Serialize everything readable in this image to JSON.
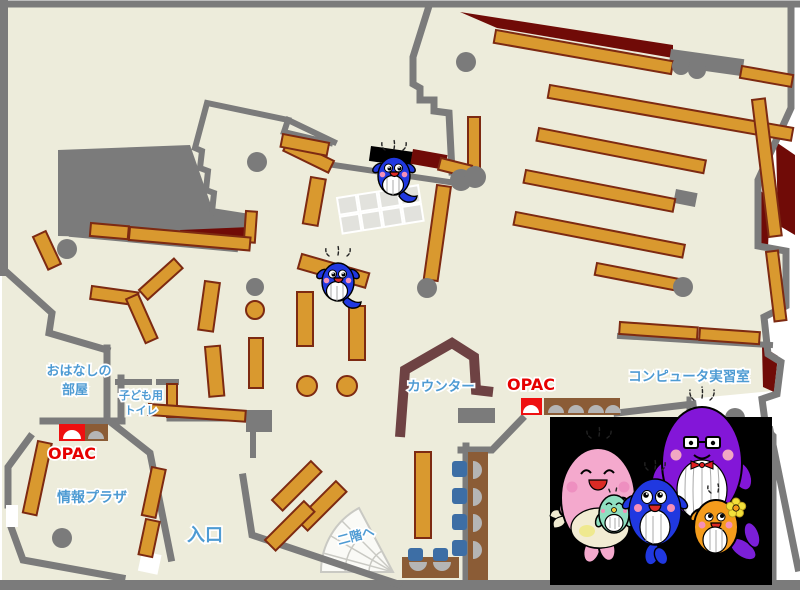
{
  "labels": {
    "storytelling_room": {
      "line1": "おはなしの",
      "line2": "部屋"
    },
    "kids_toilet": {
      "line1": "子ども用",
      "line2": "トイレ"
    },
    "opac_left": "OPAC",
    "opac_right": "OPAC",
    "info_plaza": "情報プラザ",
    "entrance": "入口",
    "counter": "カウンター",
    "to_second_floor": "二階へ",
    "computer_room": "コンピュータ実習室"
  },
  "colors": {
    "floor": "#EDECDB",
    "wall": "#7B7B7B",
    "shelf": "#D9992F",
    "shelf_border": "#7D2A12",
    "dark_red": "#700B07",
    "counter": "#6E4243",
    "label_blue": "#4E9BD3",
    "label_red": "#E60000",
    "desk_brown": "#8B5C36",
    "desk_red": "#EE1010",
    "chair_blue": "#3D6EA5",
    "dome_gray": "#B5B5B5",
    "photo_bg": "#000000",
    "grid_table": "#E2E2DD",
    "stairs": "#FAFAF6",
    "whale_blue": "#2038E0",
    "whale_purple": "#8316D8",
    "whale_pink": "#F4A9CD",
    "whale_orange": "#F49C1C",
    "whale_green": "#8FDFC0"
  },
  "mascots": {
    "on_map": [
      "blue-whale-child",
      "blue-whale-child"
    ],
    "family_photo": [
      "father-whale-purple",
      "mother-whale-pink",
      "baby-whale-green",
      "child-whale-blue",
      "child-whale-orange"
    ]
  }
}
